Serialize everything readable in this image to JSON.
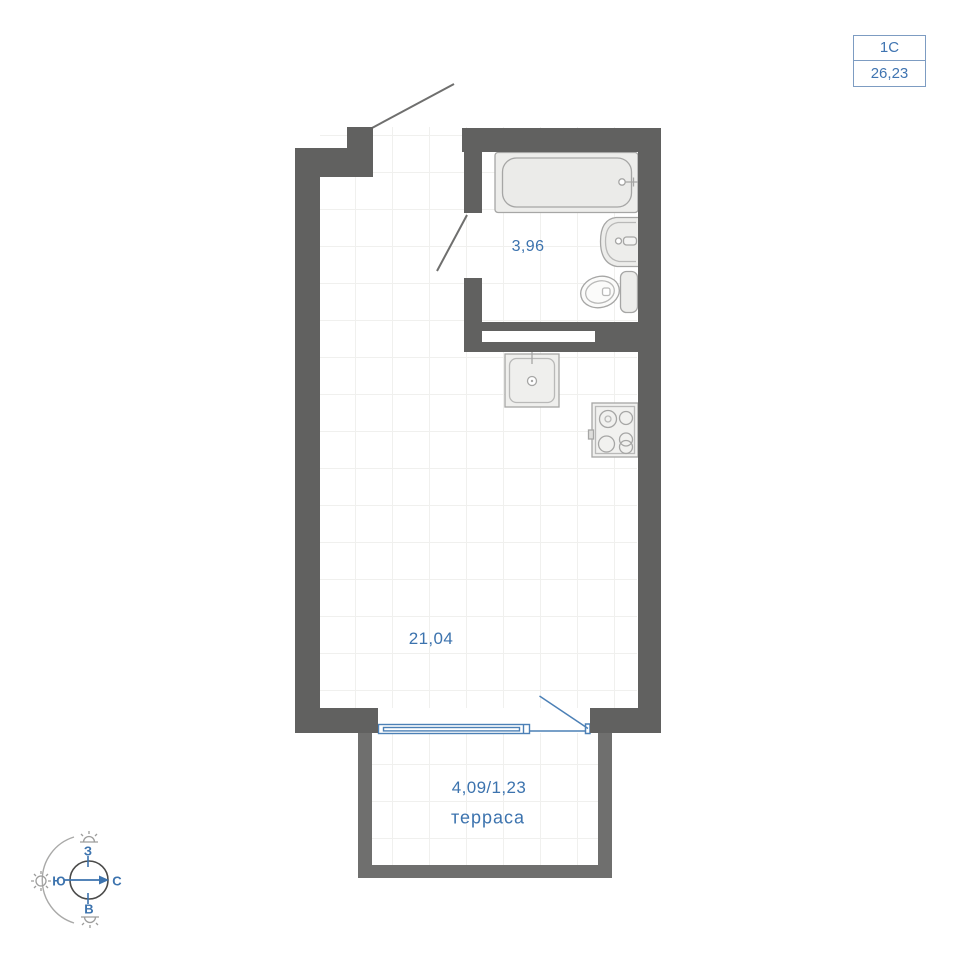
{
  "unit_card": {
    "type": "1С",
    "area": "26,23"
  },
  "labels": {
    "bathroom_area": "3,96",
    "living_area": "21,04",
    "terrace_area": "4,09/1,23",
    "terrace_name": "терраса"
  },
  "compass": {
    "west": "З",
    "south": "Ю",
    "north": "С",
    "east": "В"
  },
  "colors": {
    "wall": "#616160",
    "terrace_wall": "#6f6f6e",
    "accent_blue": "#3c73ae",
    "plan_blue": "#4c80b6",
    "fixture_stroke": "#a6a6a5",
    "fixture_fill": "#ededeb",
    "grid_line": "#f0f0ee"
  }
}
